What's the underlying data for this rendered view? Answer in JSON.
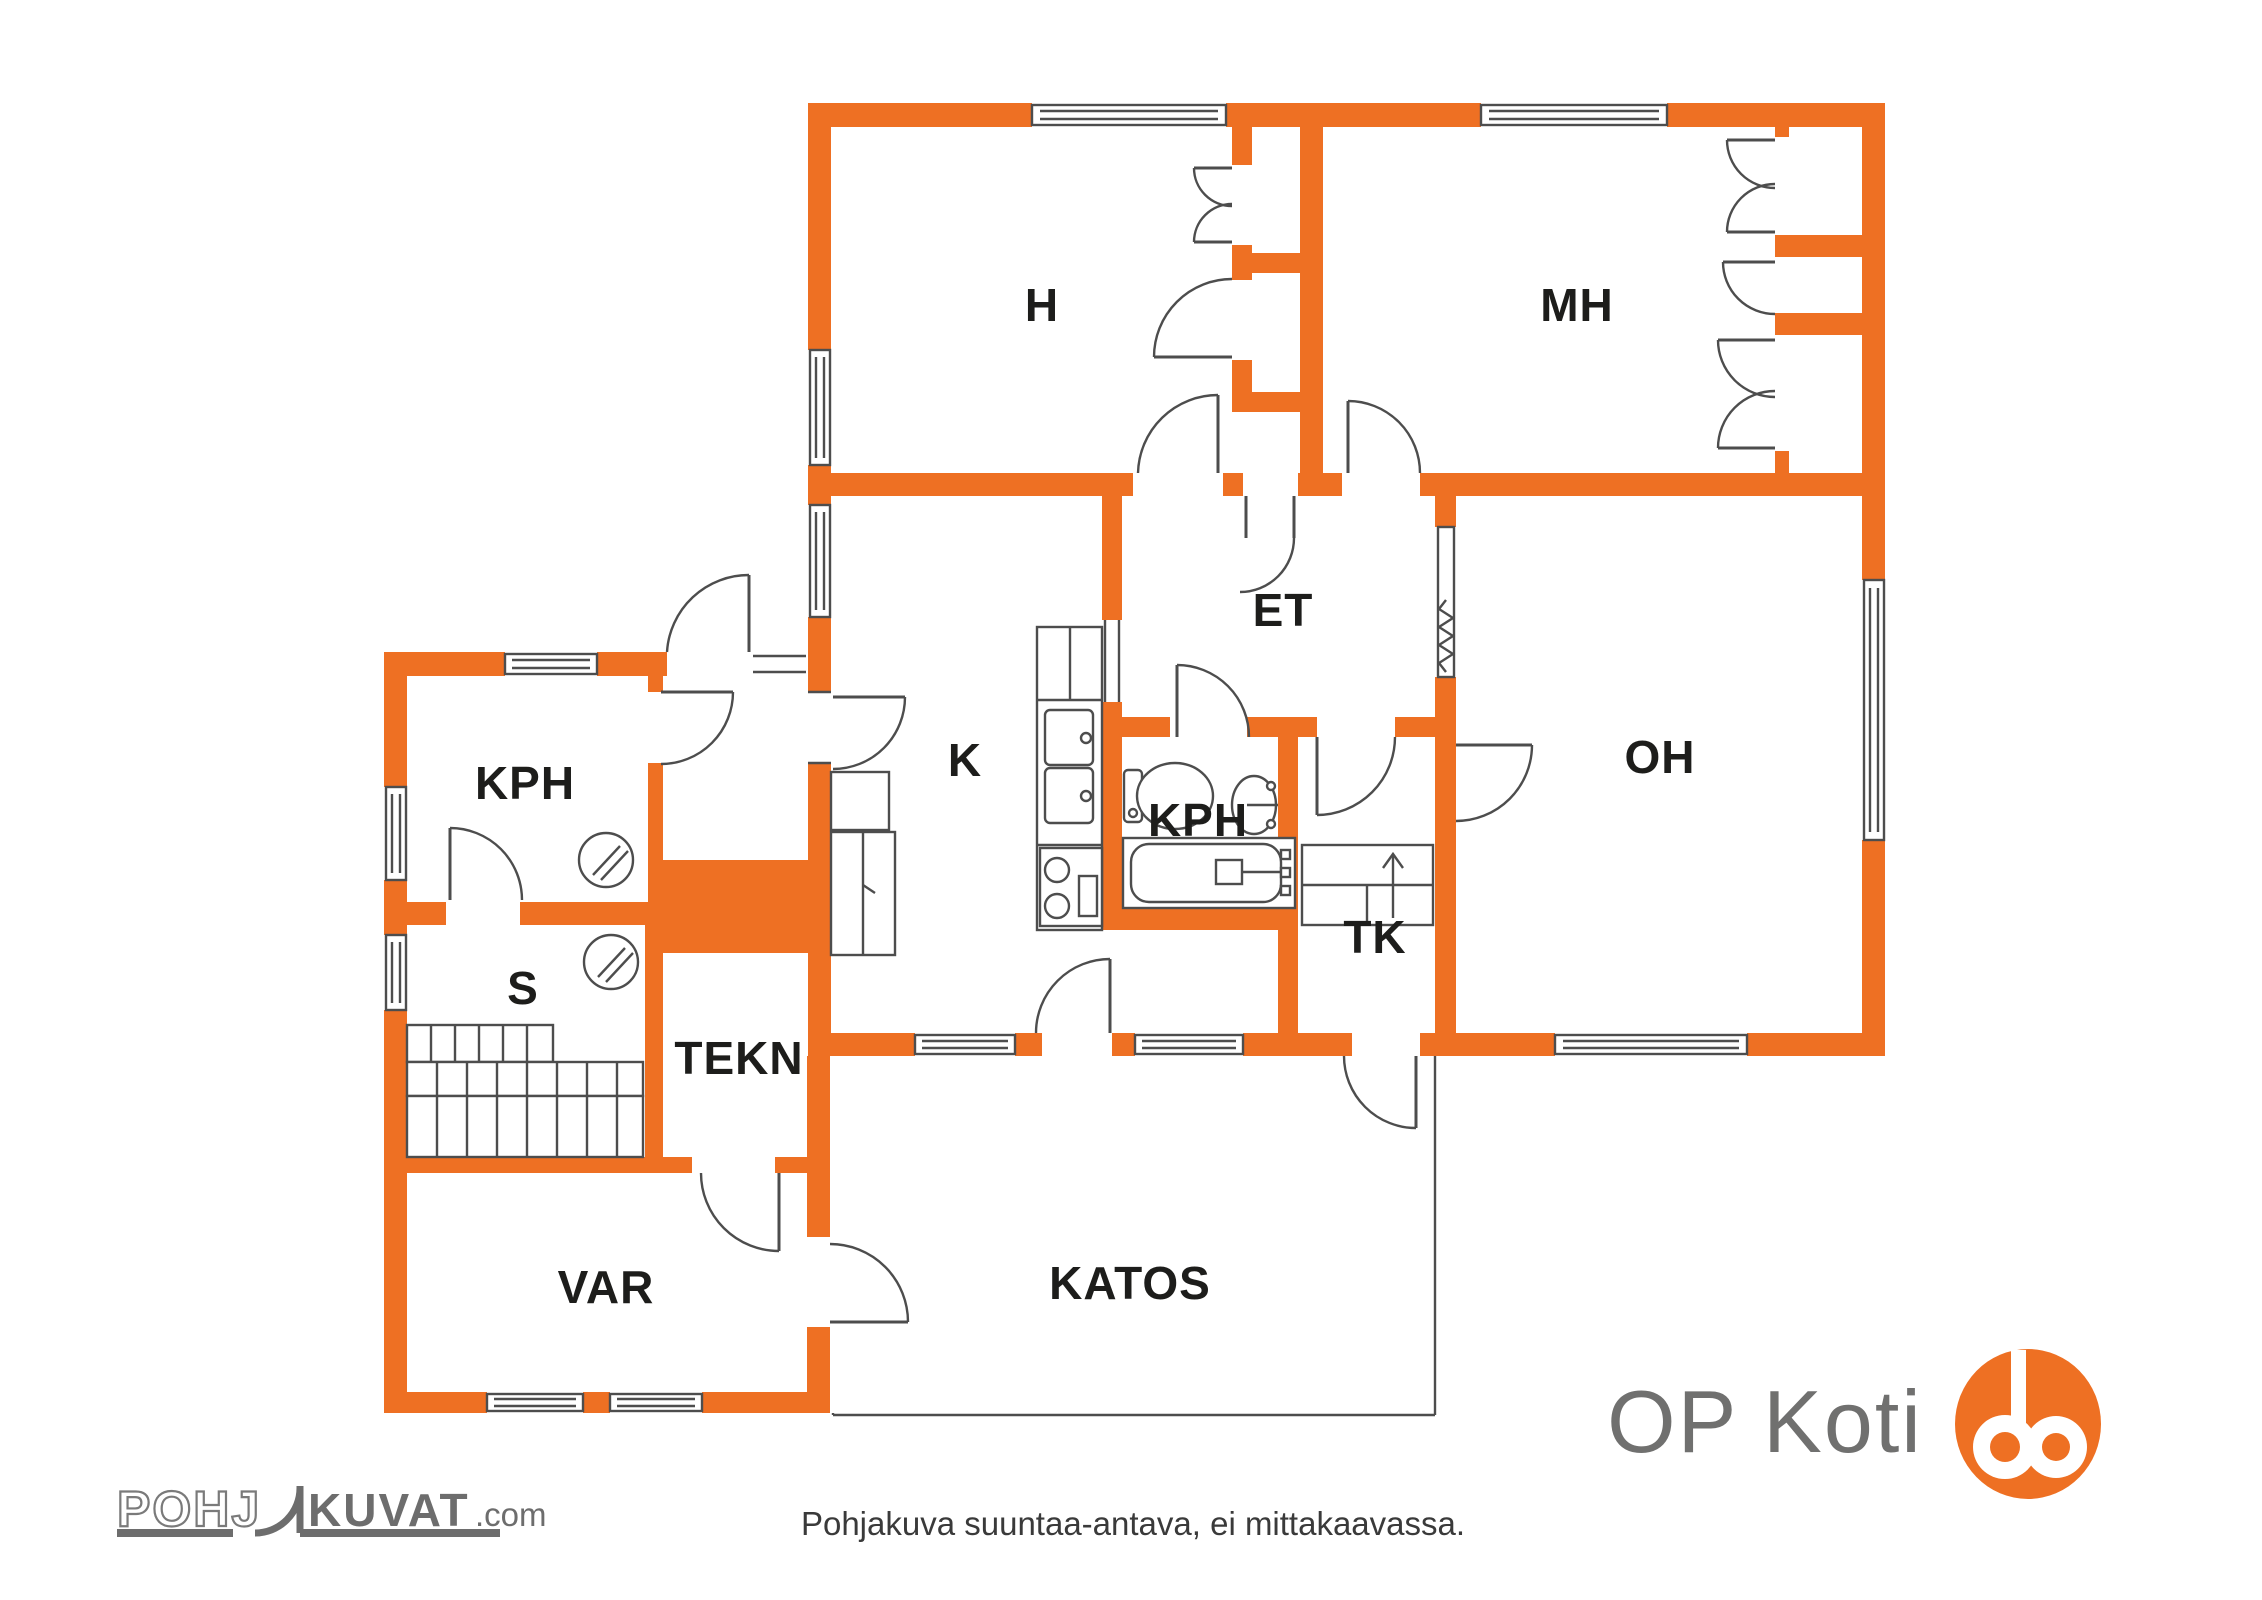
{
  "colors": {
    "wall_orange": "#EE7023",
    "line_gray": "#4d4d4d",
    "label_black": "#1d1d1b",
    "logo_gray": "#6d6d6d",
    "op_text_gray": "#70706f"
  },
  "floor_plan": {
    "rooms": [
      {
        "label": "H"
      },
      {
        "label": "MH"
      },
      {
        "label": "ET"
      },
      {
        "label": "K"
      },
      {
        "label": "KPH"
      },
      {
        "label": "OH"
      },
      {
        "label": "TK"
      },
      {
        "label": "KPH"
      },
      {
        "label": "S"
      },
      {
        "label": "TEKN"
      },
      {
        "label": "VAR"
      },
      {
        "label": "KATOS"
      }
    ]
  },
  "footer": {
    "disclaimer": "Pohjakuva suuntaa-antava, ei mittakaavassa."
  },
  "branding": {
    "op_logo_text": "OP Koti",
    "pohjakuvat_part1": "POHJ",
    "pohjakuvat_part2": "KUVAT",
    "pohjakuvat_suffix": ".com"
  }
}
